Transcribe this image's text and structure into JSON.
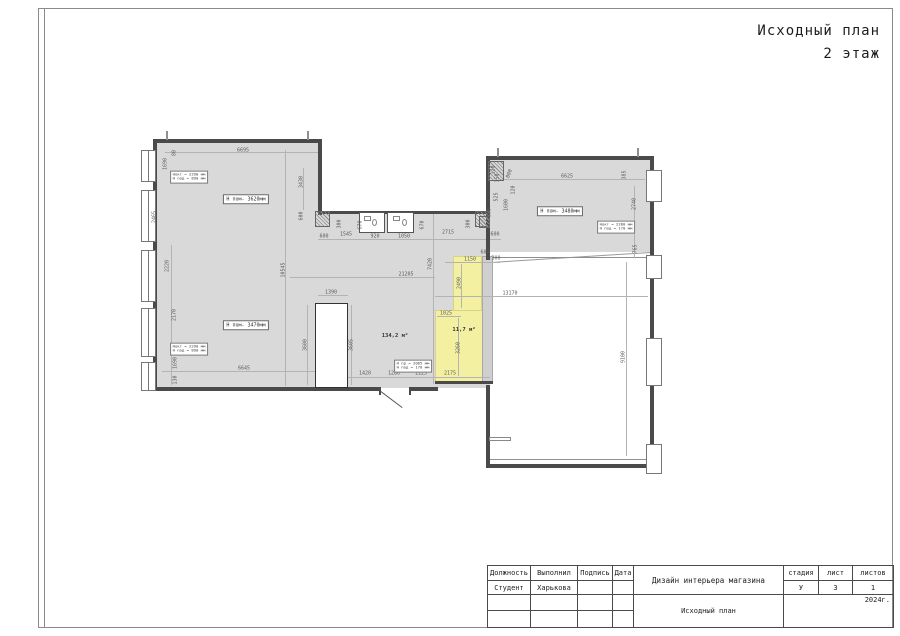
{
  "sheet": {
    "title_line1": "Исходный план",
    "title_line2": "2 этаж"
  },
  "title_block": {
    "headers": {
      "position": "Должность",
      "made_by": "Выполнил",
      "signature": "Подпись",
      "date": "Дата",
      "stage": "стадия",
      "sheet": "лист",
      "sheets": "листов"
    },
    "row": {
      "position": "Студент",
      "made_by": "Харькова",
      "signature": "",
      "date": ""
    },
    "project": "Дизайн интерьера магазина",
    "doc_title": "Исходный план",
    "stage_value": "У",
    "sheet_value": "3",
    "sheets_value": "1",
    "year": "2024г."
  },
  "plan": {
    "colors": {
      "room_fill": "#d9d9d9",
      "highlight_fill": "#f3f0a1",
      "wall": "#4a4a4a",
      "dim_text": "#5c5c5c"
    },
    "room_labels": [
      {
        "t": "Н пом- 3620мм",
        "x": 246,
        "y": 199
      },
      {
        "t": "Н пом- 3470мм",
        "x": 246,
        "y": 325
      },
      {
        "t": "Н пом- 3480мм",
        "x": 560,
        "y": 211
      }
    ],
    "area_labels": [
      {
        "t": "134,2 м²",
        "x": 395,
        "y": 336
      },
      {
        "t": "11,7 м²",
        "x": 464,
        "y": 330
      }
    ],
    "note_labels": [
      {
        "l1": "Нокт = 2290 мм",
        "l2": "Н под = 890 мм",
        "x": 189,
        "y": 177
      },
      {
        "l1": "Нокт = 2290 мм",
        "l2": "Н под = 890 мм",
        "x": 189,
        "y": 349
      },
      {
        "l1": "Нокт = 2280 мм",
        "l2": "Н под = 170 мм",
        "x": 616,
        "y": 227
      },
      {
        "l1": "Н пр = 2065 мм",
        "l2": "Н под = 170 мм",
        "x": 413,
        "y": 366
      }
    ],
    "dims": [
      {
        "t": "6695",
        "x": 243,
        "y": 151
      },
      {
        "t": "80",
        "x": 175,
        "y": 153,
        "r": -90
      },
      {
        "t": "1690",
        "x": 166,
        "y": 164,
        "r": -90
      },
      {
        "t": "2465",
        "x": 155,
        "y": 217,
        "r": -90
      },
      {
        "t": "3430",
        "x": 302,
        "y": 182,
        "r": -90
      },
      {
        "t": "600",
        "x": 302,
        "y": 216,
        "r": -90
      },
      {
        "t": "2220",
        "x": 168,
        "y": 266,
        "r": -90
      },
      {
        "t": "2170",
        "x": 175,
        "y": 315,
        "r": -90
      },
      {
        "t": "1690",
        "x": 176,
        "y": 363,
        "r": -90
      },
      {
        "t": "130",
        "x": 176,
        "y": 380,
        "r": -90
      },
      {
        "t": "600",
        "x": 324,
        "y": 237
      },
      {
        "t": "1545",
        "x": 346,
        "y": 235
      },
      {
        "t": "300",
        "x": 340,
        "y": 224,
        "r": -90
      },
      {
        "t": "670",
        "x": 361,
        "y": 225,
        "r": -90
      },
      {
        "t": "920",
        "x": 375,
        "y": 237
      },
      {
        "t": "1050",
        "x": 404,
        "y": 237
      },
      {
        "t": "670",
        "x": 423,
        "y": 225,
        "r": -90
      },
      {
        "t": "2715",
        "x": 448,
        "y": 233
      },
      {
        "t": "300",
        "x": 469,
        "y": 224,
        "r": -90
      },
      {
        "t": "600",
        "x": 495,
        "y": 235
      },
      {
        "t": "10545",
        "x": 284,
        "y": 270,
        "r": -90
      },
      {
        "t": "21205",
        "x": 406,
        "y": 275
      },
      {
        "t": "7420",
        "x": 431,
        "y": 264,
        "r": -90
      },
      {
        "t": "1150",
        "x": 470,
        "y": 260
      },
      {
        "t": "300",
        "x": 496,
        "y": 259
      },
      {
        "t": "2490",
        "x": 460,
        "y": 283,
        "r": -90
      },
      {
        "t": "13170",
        "x": 510,
        "y": 294
      },
      {
        "t": "1025",
        "x": 446,
        "y": 314
      },
      {
        "t": "3260",
        "x": 459,
        "y": 348,
        "r": -90
      },
      {
        "t": "2175",
        "x": 450,
        "y": 374
      },
      {
        "t": "1390",
        "x": 331,
        "y": 293
      },
      {
        "t": "3600",
        "x": 306,
        "y": 345,
        "r": -90
      },
      {
        "t": "3605",
        "x": 352,
        "y": 345,
        "r": -90
      },
      {
        "t": "6645",
        "x": 244,
        "y": 369
      },
      {
        "t": "1420",
        "x": 365,
        "y": 374
      },
      {
        "t": "1280",
        "x": 394,
        "y": 374
      },
      {
        "t": "1125",
        "x": 421,
        "y": 374
      },
      {
        "t": "6625",
        "x": 567,
        "y": 177
      },
      {
        "t": "385",
        "x": 625,
        "y": 175,
        "r": -90
      },
      {
        "t": "2740",
        "x": 635,
        "y": 204,
        "r": -90
      },
      {
        "t": "765",
        "x": 636,
        "y": 249,
        "r": -90
      },
      {
        "t": "9100",
        "x": 624,
        "y": 357,
        "r": -90
      },
      {
        "t": "525",
        "x": 497,
        "y": 197,
        "r": -90
      },
      {
        "t": "120",
        "x": 514,
        "y": 190,
        "r": -90
      },
      {
        "t": "1600",
        "x": 507,
        "y": 205,
        "r": -90
      },
      {
        "t": "800",
        "x": 510,
        "y": 174,
        "r": -70
      },
      {
        "t": "120",
        "x": 494,
        "y": 170,
        "r": -90
      },
      {
        "t": "150",
        "x": 498,
        "y": 178,
        "r": -90
      },
      {
        "t": "600",
        "x": 490,
        "y": 213,
        "r": -90
      },
      {
        "t": "600",
        "x": 485,
        "y": 253
      }
    ]
  }
}
